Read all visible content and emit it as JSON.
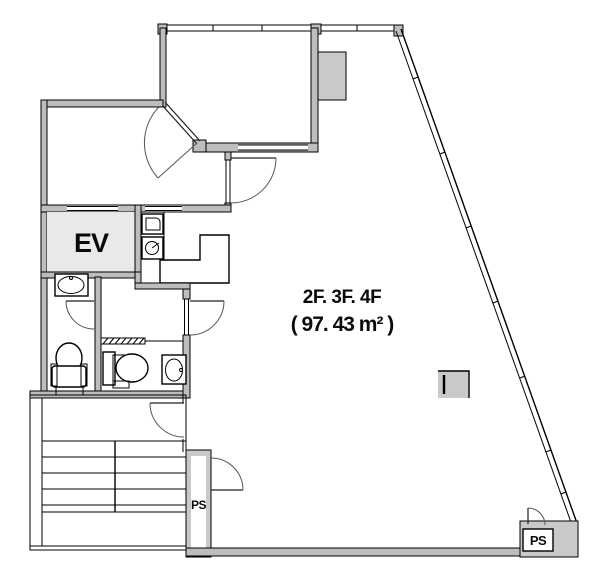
{
  "plan": {
    "title": {
      "floors": "2F. 3F. 4F",
      "area": "( 97. 43 m² )"
    },
    "labels": {
      "elevator": "EV",
      "pipe_space_1": "PS",
      "pipe_space_2": "PS"
    },
    "colors": {
      "background": "#ffffff",
      "wall": "#bdbdbd",
      "shaft_fill": "#c9c9c9",
      "ev_fill": "#e9e9e9",
      "line": "#000000"
    }
  }
}
